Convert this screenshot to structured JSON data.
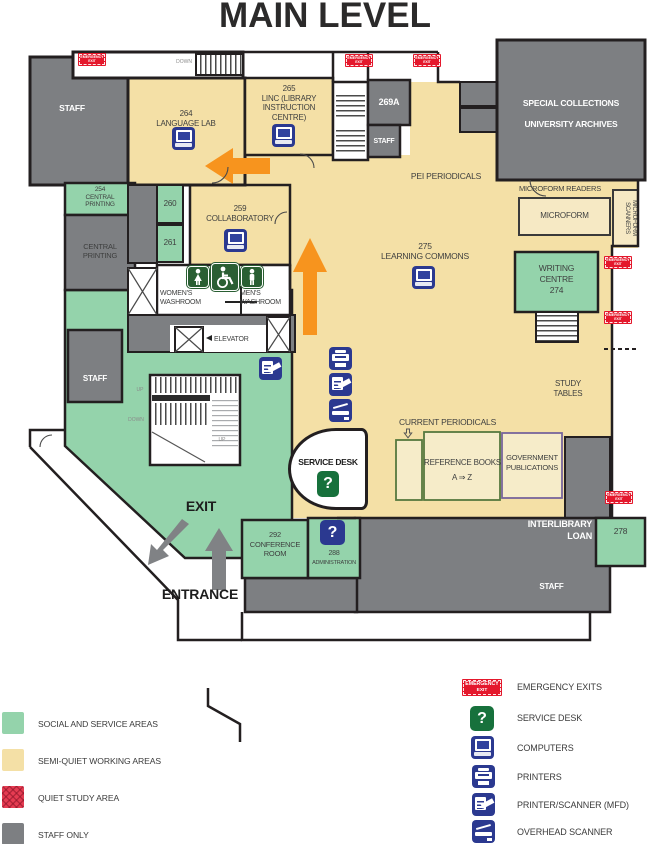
{
  "title": "MAIN LEVEL",
  "colors": {
    "social": "#94d3ab",
    "semi_quiet": "#f4e0a6",
    "quiet": "#e63c52",
    "staff": "#7d7f82",
    "wall": "#231f20",
    "icon_blue": "#2b3990",
    "icon_green": "#17713c",
    "washroom_green": "#2a5f33",
    "orange": "#f7941e",
    "emergency_red": "#e4182c"
  },
  "rooms": {
    "staff_top_left": "STAFF",
    "language_lab": [
      "264",
      "LANGUAGE  LAB"
    ],
    "linc": [
      "265",
      "LINC (LIBRARY",
      "INSTRUCTION",
      "CENTRE)"
    ],
    "room_269a": "269A",
    "staff_269": "STAFF",
    "special_collections": [
      "SPECIAL COLLECTIONS",
      "UNIVERSITY ARCHIVES"
    ],
    "pei_periodicals": "PEI PERIODICALS",
    "microform_readers": "MICROFORM READERS",
    "microform": "MICROFORM",
    "microform_scanners": [
      "MICROFORM",
      "SCANNERS"
    ],
    "central_printing_254": [
      "254",
      "CENTRAL",
      "PRINTING"
    ],
    "central_printing": [
      "CENTRAL",
      "PRINTING"
    ],
    "room_260": "260",
    "room_261": "261",
    "collaboratory": [
      "259",
      "COLLABORATORY"
    ],
    "womens_washroom": [
      "WOMEN'S",
      "WASHROOM"
    ],
    "mens_washroom": [
      "MEN'S",
      "WASHROOM"
    ],
    "elevator": "ELEVATOR",
    "learning_commons": [
      "275",
      "LEARNING COMMONS"
    ],
    "writing_centre": [
      "WRITING",
      "CENTRE",
      "274"
    ],
    "study_tables": [
      "STUDY",
      "TABLES"
    ],
    "staff_mid": "STAFF",
    "current_periodicals": "CURRENT PERIODICALS",
    "reference_books": [
      "REFERENCE BOOKS",
      "A ⇒ Z"
    ],
    "government_publications": [
      "GOVERNMENT",
      "PUBLICATIONS"
    ],
    "service_desk": "SERVICE DESK",
    "exit": "EXIT",
    "entrance": "ENTRANCE",
    "conference_room": [
      "292",
      "CONFERENCE",
      "ROOM"
    ],
    "administration": [
      "288",
      "ADMINISTRATION"
    ],
    "interlibrary_loan": [
      "INTERLIBRARY",
      "LOAN"
    ],
    "room_278": "278",
    "staff_bottom": "STAFF"
  },
  "stairs": {
    "up": "UP",
    "down": "DOWN"
  },
  "badge": [
    "EMERGENCY",
    "EXIT"
  ],
  "icons": {
    "question_mark": "?"
  },
  "legend_areas": [
    {
      "label": "SOCIAL AND SERVICE AREAS",
      "color": "#94d3ab"
    },
    {
      "label": "SEMI-QUIET WORKING AREAS",
      "color": "#f4e0a6"
    },
    {
      "label": "QUIET STUDY AREA",
      "color": "#e63c52"
    },
    {
      "label": "STAFF ONLY",
      "color": "#7d7f82"
    }
  ],
  "legend_icons": [
    {
      "icon": "emergency-exit-badge",
      "label": "EMERGENCY EXITS"
    },
    {
      "icon": "service-desk-icon",
      "label": "SERVICE DESK"
    },
    {
      "icon": "computer-icon",
      "label": "COMPUTERS"
    },
    {
      "icon": "printer-icon",
      "label": "PRINTERS"
    },
    {
      "icon": "printer-scanner-icon",
      "label": "PRINTER/SCANNER (MFD)"
    },
    {
      "icon": "overhead-scanner-icon",
      "label": "OVERHEAD SCANNER"
    }
  ]
}
